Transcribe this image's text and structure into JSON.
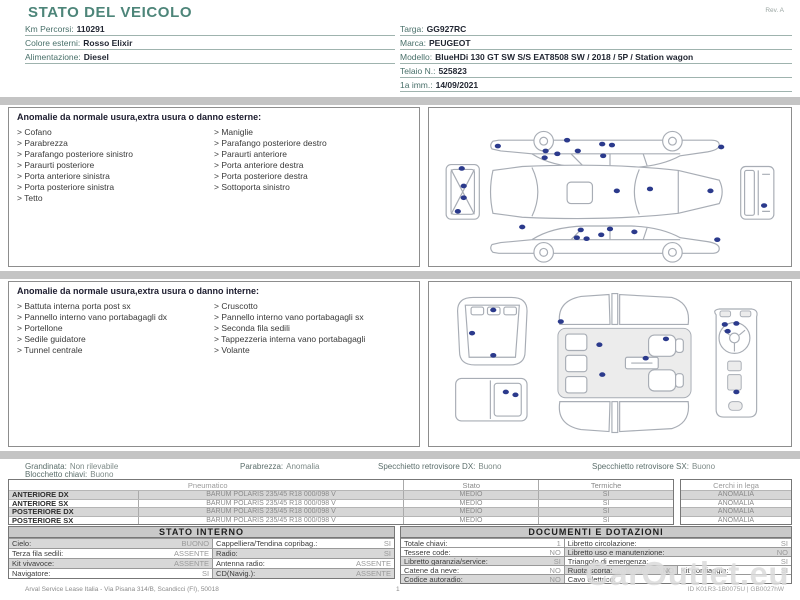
{
  "header": {
    "title": "STATO DEL VEICOLO",
    "revision": "Rev. A",
    "left_fields": [
      {
        "label": "Km Percorsi:",
        "value": "110291"
      },
      {
        "label": "Colore esterni:",
        "value": "Rosso Elixir"
      },
      {
        "label": "Alimentazione:",
        "value": "Diesel"
      }
    ],
    "right_fields": [
      {
        "label": "Targa:",
        "value": "GG927RC"
      },
      {
        "label": "Marca:",
        "value": "PEUGEOT"
      },
      {
        "label": "Modello:",
        "value": "BlueHDi 130 GT SW S/S EAT8508 SW / 2018 / 5P / Station wagon"
      },
      {
        "label": "Telaio N.:",
        "value": "525823"
      },
      {
        "label": "1a imm.:",
        "value": "14/09/2021"
      }
    ]
  },
  "exterior": {
    "heading": "Anomalie da normale usura,extra usura o danno esterne:",
    "left": [
      "> Cofano",
      "> Parabrezza",
      "> Parafango posteriore sinistro",
      "> Paraurti posteriore",
      "> Porta anteriore sinistra",
      "> Porta posteriore sinistra",
      "> Tetto"
    ],
    "right": [
      "> Maniglie",
      "> Parafango posteriore destro",
      "> Paraurti anteriore",
      "> Porta anteriore destra",
      "> Porta posteriore destra",
      "> Sottoporta sinistro"
    ]
  },
  "interior": {
    "heading": "Anomalie da normale usura,extra usura o danno interne:",
    "left": [
      "> Battuta interna porta post sx",
      "> Pannello interno vano portabagagli dx",
      "> Portellone",
      "> Sedile guidatore",
      "> Tunnel centrale"
    ],
    "right": [
      "> Cruscotto",
      "> Pannello interno vano portabagagli sx",
      "> Seconda fila sedili",
      "> Tappezzeria interna vano portabagagli",
      "> Volante"
    ]
  },
  "summary": {
    "items": [
      {
        "label": "Grandinata:",
        "value": "Non rilevabile"
      },
      {
        "label": "Parabrezza:",
        "value": "Anomalia"
      },
      {
        "label": "Specchietto retrovisore DX:",
        "value": "Buono"
      },
      {
        "label": "Specchietto retrovisore SX:",
        "value": "Buono"
      },
      {
        "label": "Blocchetto chiavi:",
        "value": "Buono"
      }
    ]
  },
  "tyres": {
    "headers": {
      "pneumatico": "Pneumatico",
      "stato": "Stato",
      "termiche": "Termiche",
      "cerchi": "Cerchi in lega"
    },
    "rows": [
      {
        "position": "ANTERIORE DX",
        "spec": "BARUM POLARIS 235/45 R18 000/098 V",
        "stato": "MEDIO",
        "termiche": "SI",
        "cerchi": "ANOMALIA"
      },
      {
        "position": "ANTERIORE SX",
        "spec": "BARUM POLARIS 235/45 R18 000/098 V",
        "stato": "MEDIO",
        "termiche": "SI",
        "cerchi": "ANOMALIA"
      },
      {
        "position": "POSTERIORE DX",
        "spec": "BARUM POLARIS 235/45 R18 000/098 V",
        "stato": "MEDIO",
        "termiche": "SI",
        "cerchi": "ANOMALIA"
      },
      {
        "position": "POSTERIORE SX",
        "spec": "BARUM POLARIS 235/45 R18 000/098 V",
        "stato": "MEDIO",
        "termiche": "SI",
        "cerchi": "ANOMALIA"
      }
    ]
  },
  "stato_interno": {
    "title": "STATO INTERNO",
    "rows": [
      [
        {
          "label": "Cielo:",
          "value": "BUONO"
        },
        {
          "label": "Cappelliera/Tendina copribag.:",
          "value": "SI"
        }
      ],
      [
        {
          "label": "Terza fila sedili:",
          "value": "ASSENTE"
        },
        {
          "label": "Radio:",
          "value": "SI"
        }
      ],
      [
        {
          "label": "Kit vivavoce:",
          "value": "ASSENTE"
        },
        {
          "label": "Antenna radio:",
          "value": "ASSENTE"
        }
      ],
      [
        {
          "label": "Navigatore:",
          "value": "SI"
        },
        {
          "label": "CD(Navig.):",
          "value": "ASSENTE"
        }
      ]
    ]
  },
  "documenti": {
    "title": "DOCUMENTI E DOTAZIONI",
    "rows": [
      [
        {
          "label": "Totale chiavi:",
          "value": "1"
        },
        {
          "label": "Libretto circolazione:",
          "value": "SI"
        }
      ],
      [
        {
          "label": "Tessere code:",
          "value": "NO"
        },
        {
          "label": "Libretto uso e manutenzione:",
          "value": "NO"
        }
      ],
      [
        {
          "label": "Libretto garanzia/service:",
          "value": "SI"
        },
        {
          "label": "Triangolo di emergenza:",
          "value": "SI"
        }
      ],
      [
        {
          "label": "Catene da neve:",
          "value": "NO"
        },
        {
          "label": "Ruota scorta:",
          "value": "NO"
        },
        {
          "label": "Kit gonfiaggio:",
          "value": "SI"
        }
      ],
      [
        {
          "label": "Codice autoradio:",
          "value": "NO"
        },
        {
          "label": "Cavo elettrico:",
          "value": ""
        }
      ]
    ]
  },
  "footer": {
    "company": "Arval Service Lease Italia - Via Pisana 314/B, Scandicci (FI), 50018",
    "page": "1",
    "doc_id": "ID K01R3-1B0075U | GB0027hW"
  },
  "watermark": "CarOutlet.eu",
  "colors": {
    "accent": "#4d8579",
    "marker": "#2b3a8c",
    "separator": "#c4c4c4"
  },
  "diagram_markers": {
    "exterior": [
      [
        138,
        33
      ],
      [
        116,
        44
      ],
      [
        115,
        51
      ],
      [
        128,
        47
      ],
      [
        149,
        44
      ],
      [
        174,
        37
      ],
      [
        184,
        38
      ],
      [
        175,
        49
      ],
      [
        296,
        40
      ],
      [
        67,
        39
      ],
      [
        30,
        62
      ],
      [
        32,
        80
      ],
      [
        32,
        92
      ],
      [
        26,
        106
      ],
      [
        189,
        85
      ],
      [
        223,
        83
      ],
      [
        285,
        85
      ],
      [
        340,
        100
      ],
      [
        92,
        122
      ],
      [
        148,
        133
      ],
      [
        152,
        125
      ],
      [
        158,
        134
      ],
      [
        173,
        130
      ],
      [
        182,
        124
      ],
      [
        207,
        127
      ],
      [
        292,
        135
      ]
    ],
    "interior": [
      [
        61,
        29
      ],
      [
        39,
        53
      ],
      [
        61,
        76
      ],
      [
        74,
        114
      ],
      [
        84,
        117
      ],
      [
        131,
        41
      ],
      [
        171,
        65
      ],
      [
        240,
        59
      ],
      [
        219,
        79
      ],
      [
        174,
        96
      ],
      [
        301,
        44
      ],
      [
        313,
        43
      ],
      [
        304,
        51
      ],
      [
        313,
        114
      ]
    ]
  }
}
